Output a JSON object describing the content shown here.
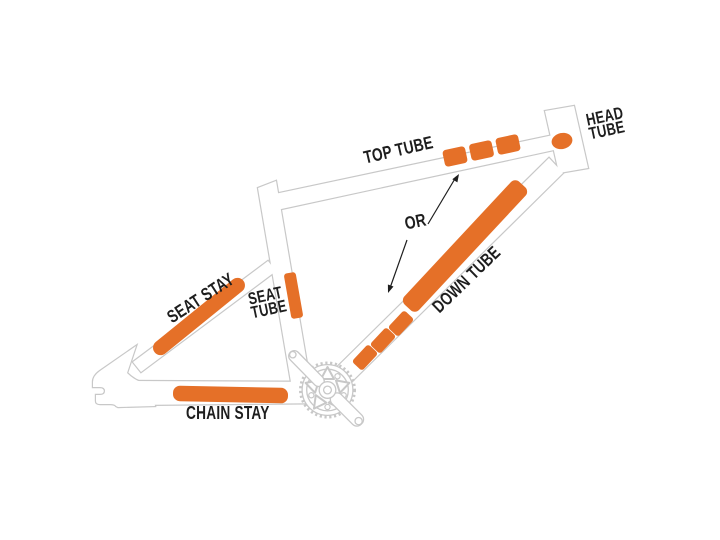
{
  "figure": {
    "background": "#FFFFFF",
    "subject": "bicycle frame protection zones diagram"
  },
  "colors": {
    "patch_orange": "#E57028",
    "frame_outline": "#C8C8C8",
    "label_text": "#1E1E1E",
    "arrow": "#1E1E1E"
  },
  "labels": {
    "top_tube": "TOP TUBE",
    "head_tube": [
      "HEAD",
      "TUBE"
    ],
    "or_connector": "OR",
    "down_tube": "DOWN TUBE",
    "seat_stay": "SEAT STAY",
    "seat_tube": [
      "SEAT",
      "TUBE"
    ],
    "chain_stay": "CHAIN STAY"
  },
  "protection_patches": {
    "head_tube_dots": 1,
    "top_tube_segments": 3,
    "down_tube_strip": 1,
    "down_tube_segments": 3,
    "seat_tube_strips": 1,
    "seat_stay_strips": 1,
    "chain_stay_strips": 1
  }
}
